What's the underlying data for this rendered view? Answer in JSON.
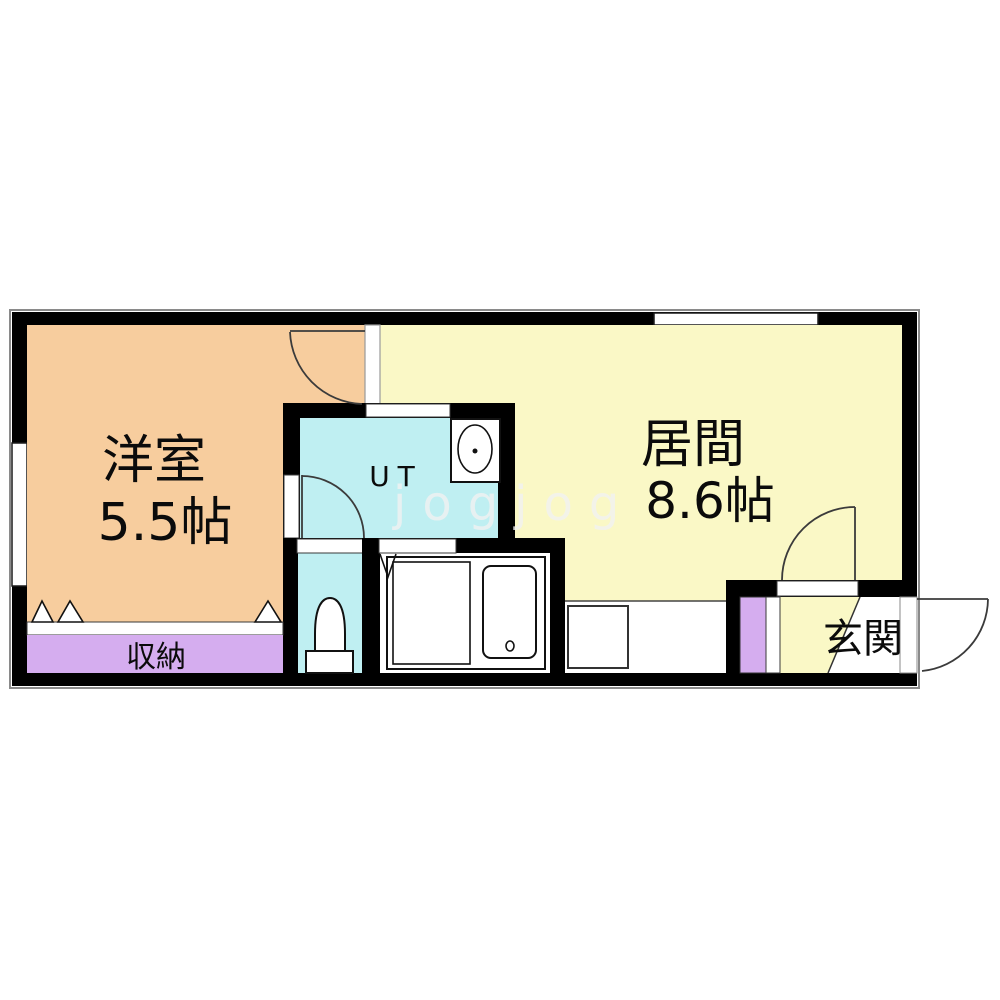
{
  "plan": {
    "watermark": "jogjog",
    "rooms": {
      "bedroom": {
        "name": "洋室",
        "size": "5.5帖"
      },
      "living": {
        "name": "居間",
        "size": "8.6帖"
      },
      "utility": {
        "name": "UT"
      },
      "closet": {
        "name": "収納"
      },
      "entrance": {
        "name": "玄関"
      }
    },
    "fixtures": [
      "toilet",
      "washbasin-sink",
      "bathtub",
      "kitchen-counter",
      "shoe-cabinet"
    ],
    "colors": {
      "bedroom": "#F7CD9E",
      "living": "#FAF8C6",
      "utility": "#BFEFF2",
      "closet": "#D5ADEF",
      "wall": "#000000",
      "floor": "#FFFFFF",
      "watermark": "#F2F2F2"
    }
  }
}
